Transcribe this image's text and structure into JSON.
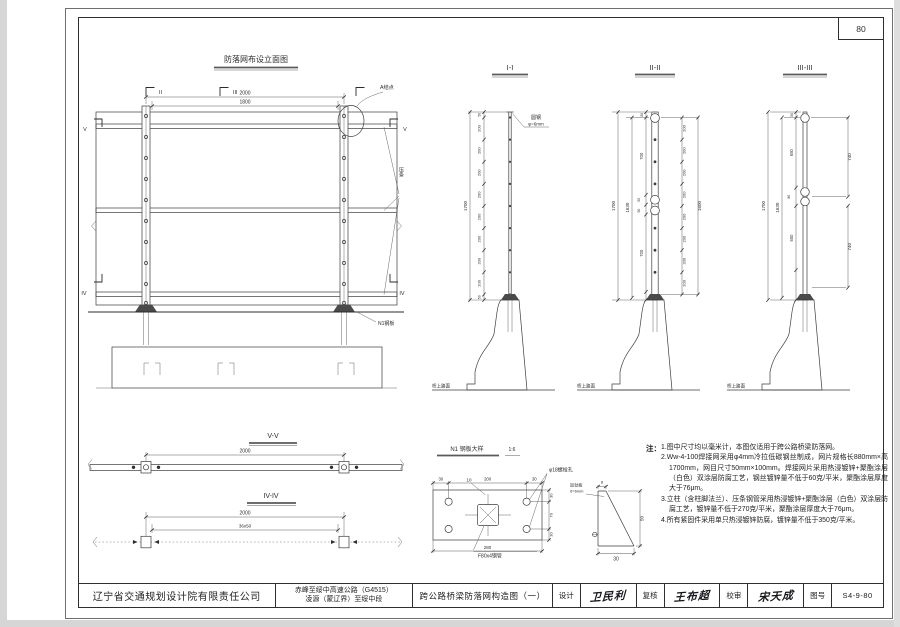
{
  "page": {
    "number": "80"
  },
  "elevation": {
    "title": "防落网布设立面图",
    "dim_outer": "2000",
    "dim_inner": "1800",
    "marker_ii": "II",
    "marker_iii": "III",
    "marker_v": "V",
    "marker_iv": "IV",
    "label_node_a": "A结点",
    "label_rail": "压条",
    "label_plate": "N1钢板"
  },
  "sections": {
    "s1": {
      "title": "I-I",
      "total": "1700",
      "segs": [
        "50",
        "200",
        "200",
        "200",
        "200",
        "200",
        "200",
        "200",
        "200",
        "50"
      ],
      "wire_label": "圆钢",
      "wire_dia": "φ=6mm",
      "ground": "桥上路面"
    },
    "s2": {
      "title": "II-II",
      "total_outer": "1700",
      "total_inner": "1630",
      "total_right": "1600",
      "mid": [
        "50",
        "700",
        "50",
        "50",
        "700"
      ],
      "right": [
        "200",
        "200",
        "200",
        "200",
        "200",
        "200",
        "200",
        "200"
      ],
      "ground": "桥上路面"
    },
    "s3": {
      "title": "III-III",
      "total_outer": "1700",
      "total_inner": "1630",
      "mid": [
        "50",
        "650",
        "80",
        "650"
      ],
      "right": [
        "740",
        "740"
      ],
      "ground": "桥上路面"
    }
  },
  "plan_views": {
    "vv": {
      "title": "V-V",
      "dim": "2000"
    },
    "iviv": {
      "title": "IV-IV",
      "dim_outer": "2000",
      "dim_inner": "36x50"
    }
  },
  "detail": {
    "title": "N1 钢板大样",
    "scale": "1:6",
    "dims_top": [
      "30",
      "200",
      "30"
    ],
    "dim_bottom": "280",
    "dims_right": [
      "30",
      "70",
      "30"
    ],
    "thickness": "10",
    "bolt_hole": "φ18螺栓孔",
    "tube": "F80x4钢管",
    "gusset": {
      "line1": "加劲板",
      "line2": "δ=6mm",
      "dim_top": "8",
      "dim_right": "50",
      "dim_bottom": "30"
    }
  },
  "notes": {
    "heading": "注：",
    "items": [
      "1.图中尺寸均以毫米计，本图仅适用于跨公路桥梁防落网。",
      "2.Ww-4-100焊接网采用φ4mm冷拉低碳钢丝制成，网片规格长880mm×高1700mm，网目尺寸50mm×100mm。焊接网片采用热浸镀锌+聚酯涂层（白色）双涂层防腐工艺，钢丝镀锌量不低于60克/平米，聚酯涂层厚度大于76μm。",
      "3.立柱（含柱脚法兰）、压条钢管采用热浸镀锌+聚酯涂层（白色）双涂层防腐工艺，镀锌量不低于270克/平米，聚酯涂层厚度大于76μm。",
      "4.所有紧固件采用单只热浸镀锌防腐，镀锌量不低于350克/平米。"
    ]
  },
  "title_block": {
    "company": "辽宁省交通规划设计院有限责任公司",
    "project_line1": "赤峰至绥中高速公路（G4515）",
    "project_line2": "凌源（蒙辽界）至绥中段",
    "drawing_title": "跨公路桥梁防落网构造图（一）",
    "design_label": "设计",
    "design_sig": "卫民利",
    "check_label": "复核",
    "check_sig": "王布超",
    "review_label": "校审",
    "review_sig": "宋天成",
    "number_label": "图号",
    "number": "S4-9-80"
  }
}
